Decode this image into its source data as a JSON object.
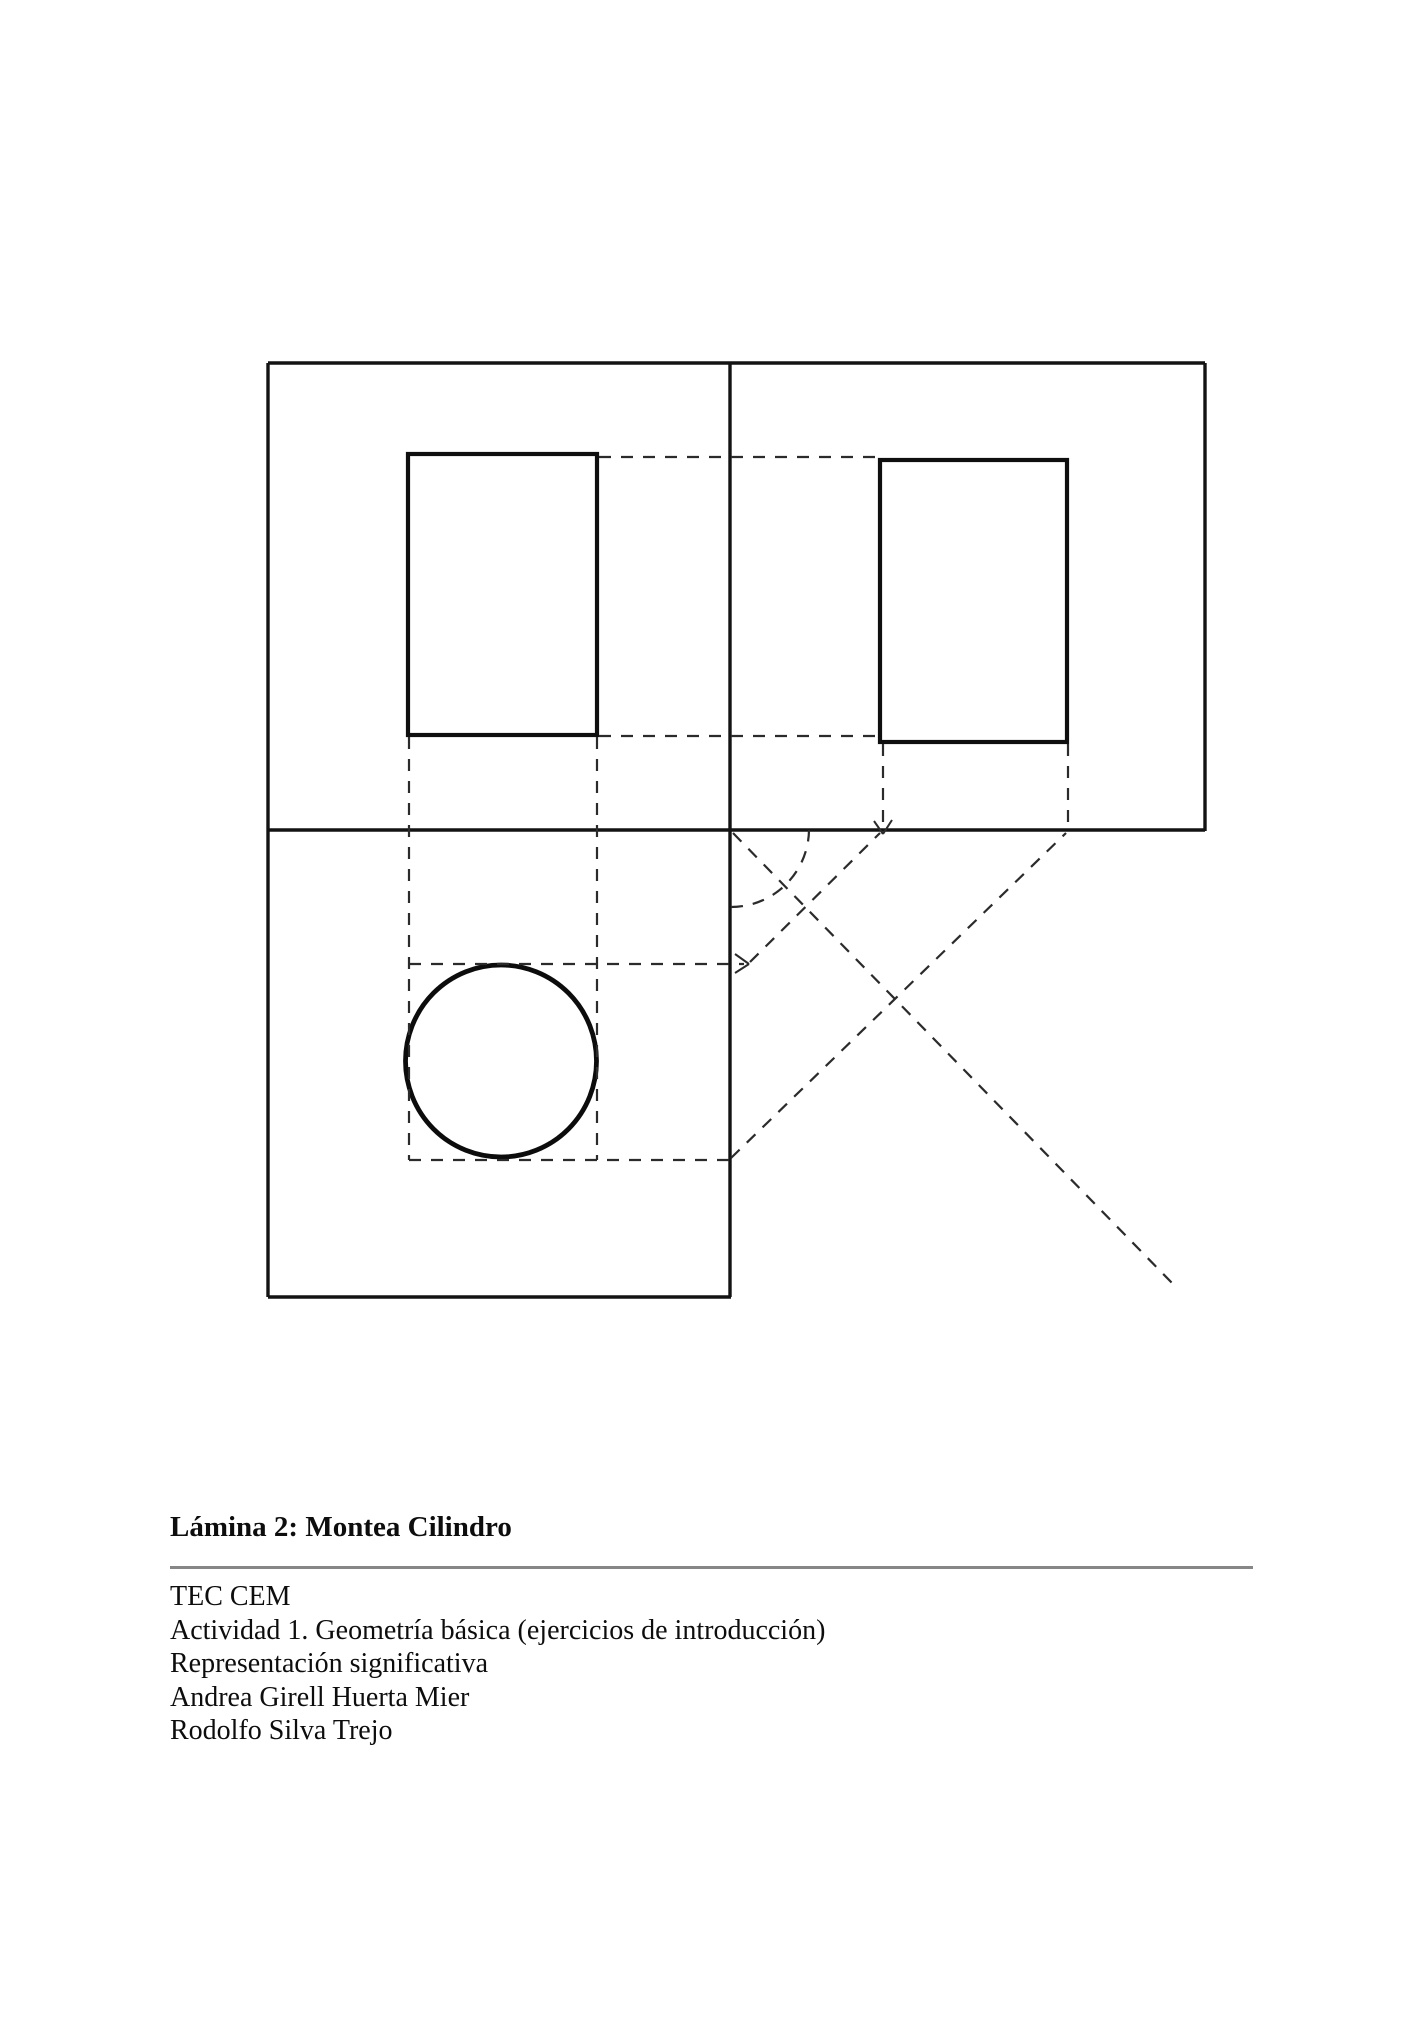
{
  "page": {
    "background": "#ffffff",
    "ink_color": "#131313",
    "rule_color": "#878787"
  },
  "figure": {
    "description_name": "montea-cilindro-orthographic-projection",
    "solid_lines": [
      [
        268,
        363,
        1205,
        363
      ],
      [
        268,
        363,
        268,
        1297
      ],
      [
        268,
        1297,
        731,
        1297
      ],
      [
        730,
        363,
        730,
        1297
      ],
      [
        1205,
        363,
        1205,
        831
      ],
      [
        268,
        830,
        1205,
        830
      ]
    ],
    "rects": [
      {
        "name": "front-view-rectangle",
        "x": 408,
        "y": 454,
        "w": 189,
        "h": 281
      },
      {
        "name": "side-view-rectangle",
        "x": 880,
        "y": 460,
        "w": 187,
        "h": 282
      }
    ],
    "ellipses": [
      {
        "name": "top-view-circle",
        "cx": 501,
        "cy": 1061,
        "rx": 95.5,
        "ry": 96
      }
    ],
    "dashed_lines": [
      [
        599,
        457,
        878,
        457
      ],
      [
        599,
        736,
        878,
        736
      ],
      [
        409,
        737,
        409,
        1160
      ],
      [
        597,
        737,
        597,
        1160
      ],
      [
        409,
        964,
        744,
        964
      ],
      [
        409,
        1160,
        729,
        1160
      ],
      [
        883,
        744,
        883,
        830
      ],
      [
        1068,
        744,
        1068,
        828
      ],
      [
        733,
        833,
        1172,
        1283
      ],
      [
        750,
        962,
        880,
        833
      ],
      [
        731,
        1158,
        1066,
        833
      ]
    ],
    "dashed_arcs": [
      {
        "r": 78,
        "x1": 731,
        "y1": 907,
        "x2": 809,
        "y2": 830
      }
    ],
    "arrow_segments": [
      [
        735,
        954,
        749,
        964
      ],
      [
        735,
        973,
        749,
        964
      ],
      [
        874,
        821,
        883,
        834
      ],
      [
        892,
        820,
        883,
        834
      ]
    ]
  },
  "caption": {
    "title": "Lámina 2: Montea Cilindro",
    "lines": [
      "TEC CEM",
      "Actividad 1. Geometría básica (ejercicios de introducción)",
      "Representación significativa",
      "Andrea Girell Huerta Mier",
      "Rodolfo Silva Trejo"
    ]
  }
}
